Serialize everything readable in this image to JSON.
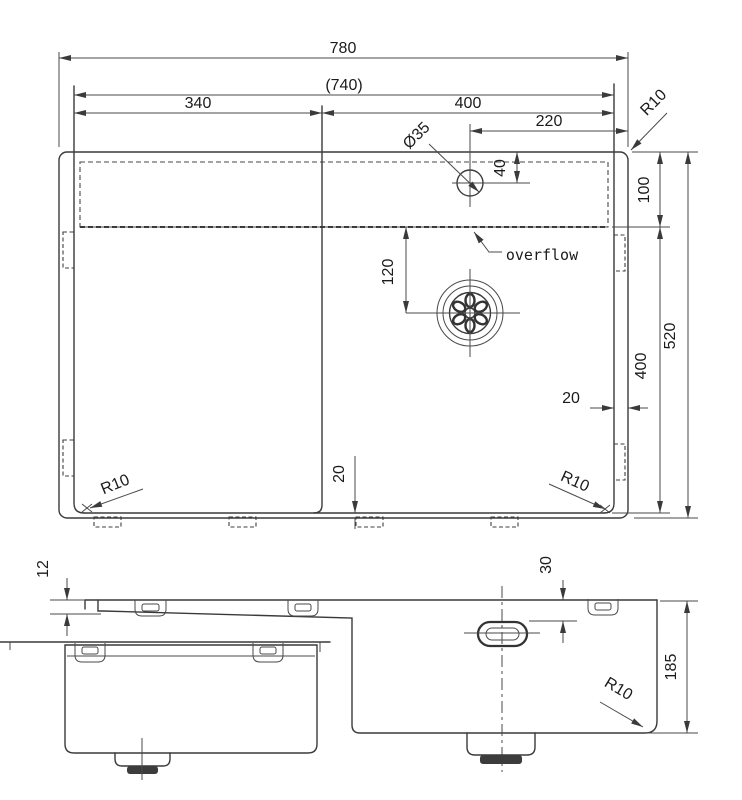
{
  "top_view": {
    "width_overall": "780",
    "width_inner": "(740)",
    "width_left_bowl": "340",
    "width_right_bowl": "400",
    "tap_hole_offset": "220",
    "tap_hole_diameter": "Ø35",
    "tap_hole_from_edge": "40",
    "ledge_depth": "100",
    "depth_overall": "520",
    "bowl_inner_depth": "400",
    "drain_from_ledge": "120",
    "rim_gap_bottom": "20",
    "rim_gap_right": "20",
    "radius_top_right": "R10",
    "radius_bottom_left": "R10",
    "radius_bottom_right": "R10",
    "overflow_label": "overflow"
  },
  "front_view": {
    "rim_to_deck": "12",
    "overflow_from_top": "30",
    "bowl_depth": "185",
    "bottom_radius": "R10"
  }
}
